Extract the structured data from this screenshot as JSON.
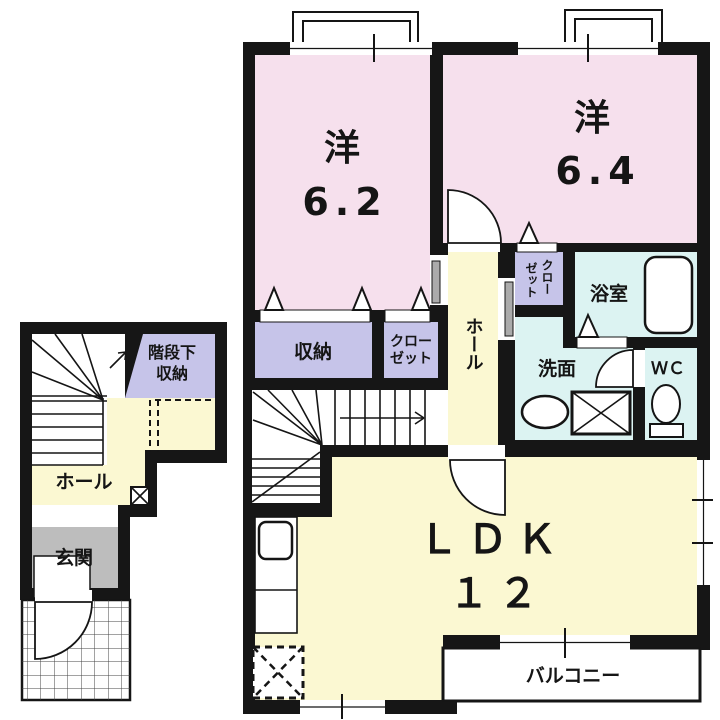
{
  "rooms": {
    "bedroom1": {
      "label": "洋",
      "size": "6.2"
    },
    "bedroom2": {
      "label": "洋",
      "size": "6.4"
    },
    "storage": {
      "label": "収納"
    },
    "closet": {
      "line1": "クロー",
      "line2": "ゼット"
    },
    "hall_2f": {
      "label": "ホール"
    },
    "small_closet": {
      "col_right": "クロー",
      "col_left": "ゼット"
    },
    "bathroom": {
      "label": "浴室"
    },
    "washroom": {
      "label": "洗面"
    },
    "toilet": {
      "label": "ＷＣ"
    },
    "ldk": {
      "label": "ＬＤＫ",
      "size": "１２"
    },
    "balcony": {
      "label": "バルコニー"
    },
    "understairs": {
      "line1": "階段下",
      "line2": "収納"
    },
    "hall_1f": {
      "label": "ホール"
    },
    "entrance": {
      "label": "玄関"
    }
  },
  "colors": {
    "wall": "#161616",
    "bedroom": "#F6E0ED",
    "storage": "#C6C4E9",
    "living": "#FBF8D2",
    "wet": "#DCF3F2",
    "entrance_floor": "#BDBDBD",
    "door_slab": "#ABABAB",
    "background": "#FFFFFF"
  }
}
